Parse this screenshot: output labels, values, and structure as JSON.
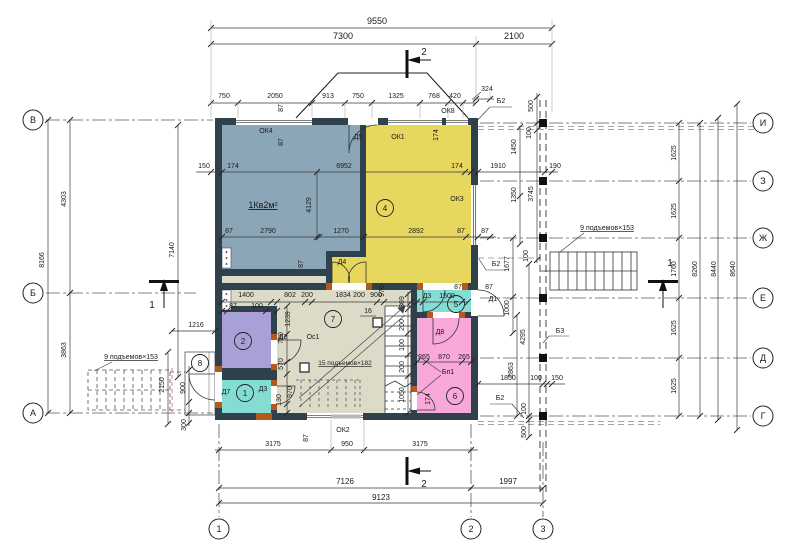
{
  "drawing": {
    "apartment_label": "1Кв2м²",
    "stair_note_left": "9 подъемов×153",
    "stair_note_right": "9 подъемов×153",
    "stair_note_inner": "15 подъемов×182"
  },
  "colors": {
    "wall": "#30414e",
    "room_living_blue": "#8ba6b6",
    "room_hall_yellow": "#e7d75f",
    "room_purple": "#a9a0d8",
    "room_cyan": "#84dcd3",
    "room_cyan2": "#84dcd3",
    "room_pink": "#f8a9da",
    "room_beige": "#dcdbc7",
    "accent_orange": "#b4591b",
    "line": "#3a3a3a",
    "axis": "#5a5a5a",
    "sill_gray": "#b5b9bb"
  },
  "axis_circles": [
    {
      "l": "В",
      "x": 33,
      "y": 120
    },
    {
      "l": "Б",
      "x": 33,
      "y": 293
    },
    {
      "l": "А",
      "x": 33,
      "y": 413
    },
    {
      "l": "И",
      "x": 763,
      "y": 123
    },
    {
      "l": "З",
      "x": 763,
      "y": 181
    },
    {
      "l": "Ж",
      "x": 763,
      "y": 238
    },
    {
      "l": "Е",
      "x": 763,
      "y": 298
    },
    {
      "l": "Д",
      "x": 763,
      "y": 358
    },
    {
      "l": "Г",
      "x": 763,
      "y": 416
    },
    {
      "l": "1",
      "x": 219,
      "y": 529
    },
    {
      "l": "2",
      "x": 471,
      "y": 529
    },
    {
      "l": "3",
      "x": 543,
      "y": 529
    }
  ],
  "room_badges": [
    {
      "n": "1",
      "x": 245,
      "y": 393
    },
    {
      "n": "2",
      "x": 243,
      "y": 341
    },
    {
      "n": "4",
      "x": 385,
      "y": 208
    },
    {
      "n": "5",
      "x": 456,
      "y": 304
    },
    {
      "n": "6",
      "x": 455,
      "y": 396
    },
    {
      "n": "7",
      "x": 333,
      "y": 319
    },
    {
      "n": "8",
      "x": 200,
      "y": 363
    }
  ],
  "labels": [
    {
      "t": "9550",
      "x": 377,
      "y": 24,
      "s": 9
    },
    {
      "t": "7300",
      "x": 343,
      "y": 39,
      "s": 9
    },
    {
      "t": "2100",
      "x": 514,
      "y": 39,
      "s": 9
    },
    {
      "t": "750",
      "x": 224,
      "y": 98
    },
    {
      "t": "2050",
      "x": 275,
      "y": 98
    },
    {
      "t": "913",
      "x": 328,
      "y": 98
    },
    {
      "t": "750",
      "x": 358,
      "y": 98
    },
    {
      "t": "1325",
      "x": 396,
      "y": 98
    },
    {
      "t": "768",
      "x": 434,
      "y": 98
    },
    {
      "t": "420",
      "x": 455,
      "y": 98
    },
    {
      "t": "324",
      "x": 487,
      "y": 91
    },
    {
      "t": "2",
      "x": 424,
      "y": 55,
      "s": 10
    },
    {
      "t": "2",
      "x": 424,
      "y": 487,
      "s": 10
    },
    {
      "t": "1",
      "x": 152,
      "y": 308,
      "s": 10
    },
    {
      "t": "1",
      "x": 670,
      "y": 266,
      "s": 10
    },
    {
      "t": "ОК8",
      "x": 448,
      "y": 113
    },
    {
      "t": "Б2",
      "x": 501,
      "y": 103
    },
    {
      "t": "Б2",
      "x": 496,
      "y": 266
    },
    {
      "t": "Б2",
      "x": 500,
      "y": 400
    },
    {
      "t": "Б3",
      "x": 560,
      "y": 333
    },
    {
      "t": "87",
      "x": 283,
      "y": 108,
      "r": 1
    },
    {
      "t": "87",
      "x": 283,
      "y": 142,
      "r": 1
    },
    {
      "t": "87",
      "x": 303,
      "y": 264,
      "r": 1
    },
    {
      "t": "ОК4",
      "x": 266,
      "y": 133
    },
    {
      "t": "Д5",
      "x": 358,
      "y": 139
    },
    {
      "t": "ОК1",
      "x": 398,
      "y": 139
    },
    {
      "t": "174",
      "x": 438,
      "y": 135,
      "r": 1
    },
    {
      "t": "150",
      "x": 204,
      "y": 168
    },
    {
      "t": "174",
      "x": 233,
      "y": 168
    },
    {
      "t": "6952",
      "x": 344,
      "y": 168
    },
    {
      "t": "174",
      "x": 457,
      "y": 168
    },
    {
      "t": "1910",
      "x": 498,
      "y": 168
    },
    {
      "t": "190",
      "x": 555,
      "y": 168
    },
    {
      "t": "500",
      "x": 533,
      "y": 106,
      "r": 1
    },
    {
      "t": "100",
      "x": 531,
      "y": 133,
      "r": 1
    },
    {
      "t": "1450",
      "x": 516,
      "y": 147,
      "r": 1
    },
    {
      "t": "1350",
      "x": 516,
      "y": 195,
      "r": 1
    },
    {
      "t": "3745",
      "x": 533,
      "y": 194,
      "r": 1
    },
    {
      "t": "1Кв2м²",
      "x": 263,
      "y": 208,
      "s": 9,
      "u": 1
    },
    {
      "t": "4129",
      "x": 311,
      "y": 205,
      "r": 1
    },
    {
      "t": "ОК3",
      "x": 457,
      "y": 201
    },
    {
      "t": "87",
      "x": 229,
      "y": 233
    },
    {
      "t": "2790",
      "x": 268,
      "y": 233
    },
    {
      "t": "1270",
      "x": 341,
      "y": 233
    },
    {
      "t": "2892",
      "x": 416,
      "y": 233
    },
    {
      "t": "87",
      "x": 461,
      "y": 233
    },
    {
      "t": "87",
      "x": 485,
      "y": 233
    },
    {
      "t": "Д4",
      "x": 342,
      "y": 264
    },
    {
      "t": "1625",
      "x": 676,
      "y": 153,
      "r": 1
    },
    {
      "t": "1625",
      "x": 676,
      "y": 211,
      "r": 1
    },
    {
      "t": "1760",
      "x": 676,
      "y": 269,
      "r": 1
    },
    {
      "t": "8260",
      "x": 697,
      "y": 269,
      "r": 1
    },
    {
      "t": "8440",
      "x": 716,
      "y": 269,
      "r": 1
    },
    {
      "t": "8640",
      "x": 735,
      "y": 269,
      "r": 1
    },
    {
      "t": "1625",
      "x": 676,
      "y": 328,
      "r": 1
    },
    {
      "t": "1625",
      "x": 676,
      "y": 386,
      "r": 1
    },
    {
      "t": "9 подъемов×153",
      "x": 607,
      "y": 230,
      "u": 1
    },
    {
      "t": "9 подъемов×153",
      "x": 131,
      "y": 359,
      "u": 1
    },
    {
      "t": "1677",
      "x": 509,
      "y": 264,
      "r": 1
    },
    {
      "t": "100",
      "x": 528,
      "y": 256,
      "r": 1
    },
    {
      "t": "1000",
      "x": 509,
      "y": 308,
      "r": 1
    },
    {
      "t": "4295",
      "x": 525,
      "y": 337,
      "r": 1
    },
    {
      "t": "2863",
      "x": 513,
      "y": 370,
      "r": 1
    },
    {
      "t": "1850",
      "x": 508,
      "y": 380
    },
    {
      "t": "100",
      "x": 536,
      "y": 380
    },
    {
      "t": "150",
      "x": 557,
      "y": 380
    },
    {
      "t": "100",
      "x": 526,
      "y": 409,
      "r": 1
    },
    {
      "t": "500",
      "x": 526,
      "y": 432,
      "r": 1
    },
    {
      "t": "8166",
      "x": 44,
      "y": 260,
      "r": 1
    },
    {
      "t": "4303",
      "x": 66,
      "y": 199,
      "r": 1
    },
    {
      "t": "3863",
      "x": 66,
      "y": 350,
      "r": 1
    },
    {
      "t": "7140",
      "x": 174,
      "y": 250,
      "r": 1
    },
    {
      "t": "1216",
      "x": 196,
      "y": 327
    },
    {
      "t": "2150",
      "x": 164,
      "y": 385,
      "r": 1
    },
    {
      "t": "900",
      "x": 185,
      "y": 388,
      "r": 1
    },
    {
      "t": "300",
      "x": 186,
      "y": 425,
      "r": 1
    },
    {
      "t": "1400",
      "x": 246,
      "y": 297
    },
    {
      "t": "87",
      "x": 233,
      "y": 308
    },
    {
      "t": "100",
      "x": 257,
      "y": 308
    },
    {
      "t": "802",
      "x": 290,
      "y": 297
    },
    {
      "t": "200",
      "x": 307,
      "y": 297
    },
    {
      "t": "1834",
      "x": 343,
      "y": 297
    },
    {
      "t": "200",
      "x": 359,
      "y": 297
    },
    {
      "t": "900",
      "x": 376,
      "y": 297
    },
    {
      "t": "970",
      "x": 384,
      "y": 291,
      "r": 1
    },
    {
      "t": "1239",
      "x": 290,
      "y": 319,
      "r": 1
    },
    {
      "t": "780",
      "x": 283,
      "y": 338,
      "r": 1
    },
    {
      "t": "570",
      "x": 283,
      "y": 364,
      "r": 1
    },
    {
      "t": "970",
      "x": 292,
      "y": 392,
      "r": 1
    },
    {
      "t": "130",
      "x": 281,
      "y": 400,
      "r": 1
    },
    {
      "t": "Д2",
      "x": 283,
      "y": 339
    },
    {
      "t": "Ос1",
      "x": 313,
      "y": 339
    },
    {
      "t": "16",
      "x": 368,
      "y": 313
    },
    {
      "t": "15 подъемов×182",
      "x": 345,
      "y": 365,
      "s": 6.5,
      "u": 1
    },
    {
      "t": "369",
      "x": 404,
      "y": 302,
      "r": 1
    },
    {
      "t": "200",
      "x": 404,
      "y": 325,
      "r": 1
    },
    {
      "t": "100",
      "x": 404,
      "y": 345,
      "r": 1
    },
    {
      "t": "200",
      "x": 404,
      "y": 367,
      "r": 1
    },
    {
      "t": "1050",
      "x": 404,
      "y": 395,
      "r": 1
    },
    {
      "t": "Д3",
      "x": 263,
      "y": 391
    },
    {
      "t": "Д7",
      "x": 226,
      "y": 394
    },
    {
      "t": "Д3",
      "x": 427,
      "y": 298
    },
    {
      "t": "1500",
      "x": 447,
      "y": 298
    },
    {
      "t": "87",
      "x": 458,
      "y": 289
    },
    {
      "t": "87",
      "x": 489,
      "y": 289
    },
    {
      "t": "Д1",
      "x": 493,
      "y": 301
    },
    {
      "t": "Д8",
      "x": 440,
      "y": 334
    },
    {
      "t": "265",
      "x": 424,
      "y": 359
    },
    {
      "t": "870",
      "x": 444,
      "y": 359
    },
    {
      "t": "265",
      "x": 464,
      "y": 359
    },
    {
      "t": "Бп1",
      "x": 448,
      "y": 374
    },
    {
      "t": "174",
      "x": 430,
      "y": 399,
      "r": 1
    },
    {
      "t": "87",
      "x": 308,
      "y": 438,
      "r": 1
    },
    {
      "t": "ОК2",
      "x": 343,
      "y": 432
    },
    {
      "t": "3175",
      "x": 273,
      "y": 446
    },
    {
      "t": "950",
      "x": 347,
      "y": 446
    },
    {
      "t": "3175",
      "x": 420,
      "y": 446
    },
    {
      "t": "7126",
      "x": 345,
      "y": 484,
      "s": 8
    },
    {
      "t": "1997",
      "x": 508,
      "y": 484,
      "s": 8
    },
    {
      "t": "9123",
      "x": 381,
      "y": 500,
      "s": 8
    }
  ]
}
